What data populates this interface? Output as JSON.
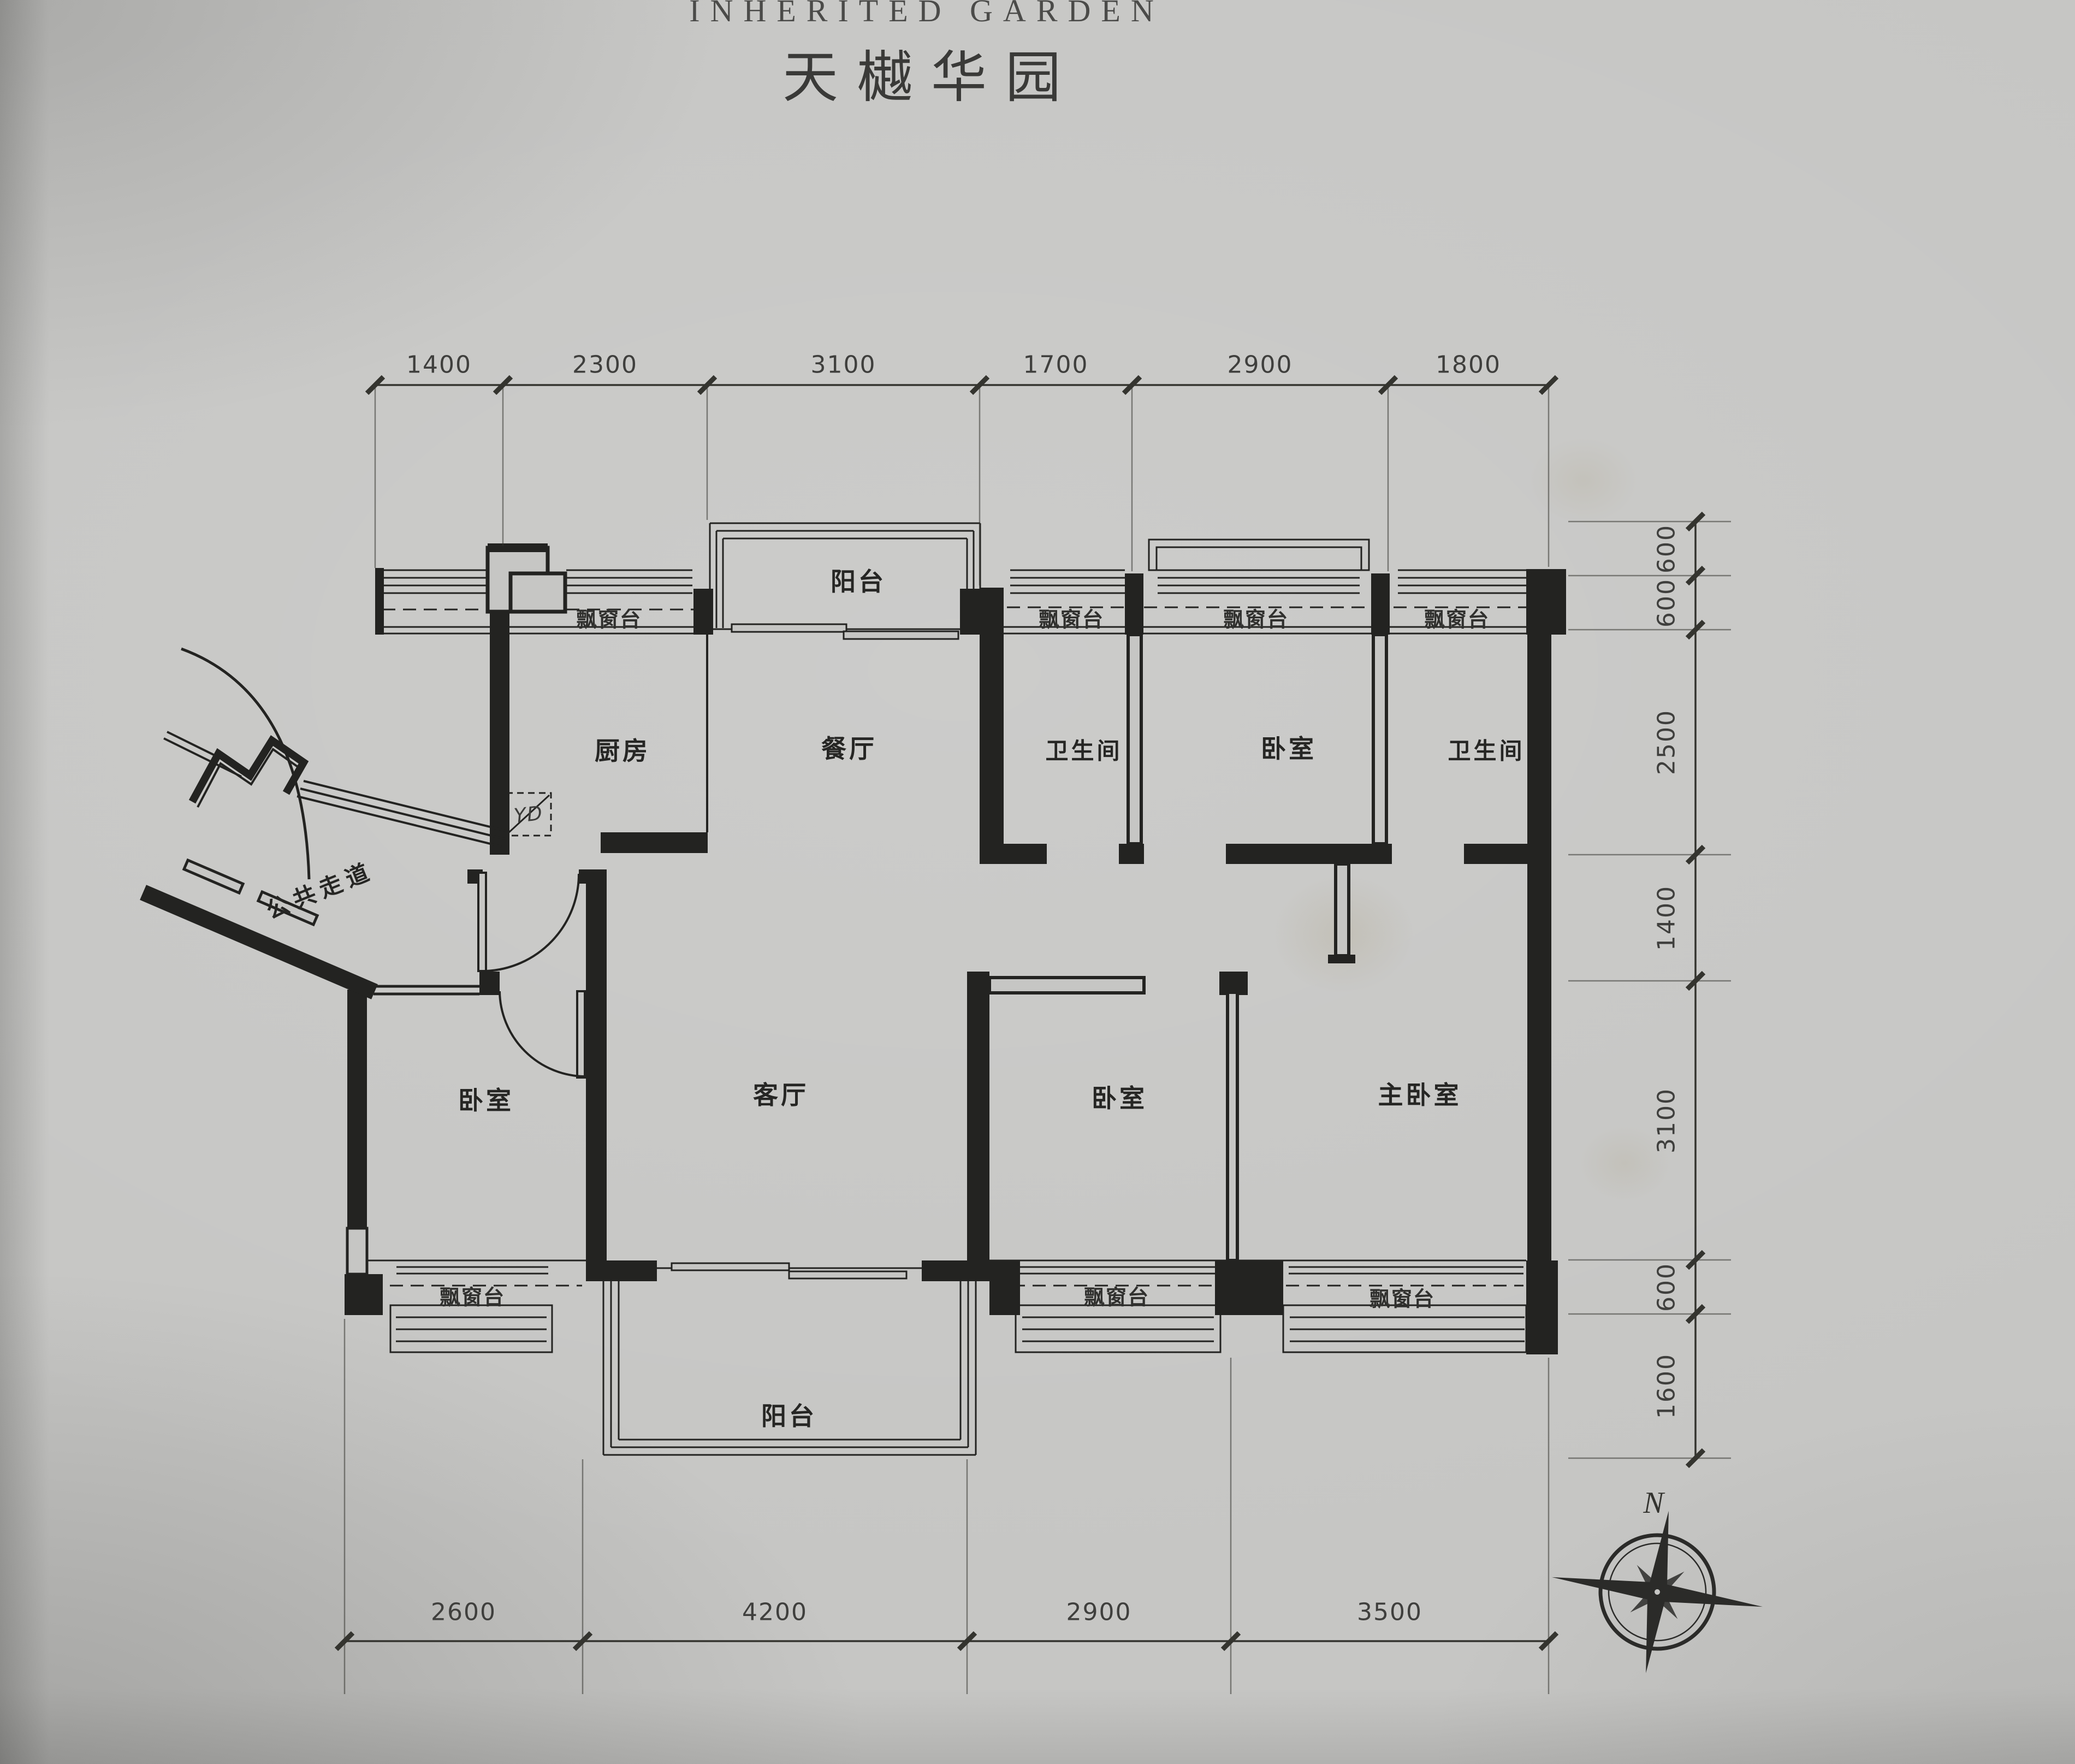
{
  "header": {
    "title_en": "INHERITED GARDEN",
    "title_zh": "天樾华园"
  },
  "plan": {
    "rooms": [
      {
        "id": "kitchen",
        "label": "厨房"
      },
      {
        "id": "dining",
        "label": "餐厅"
      },
      {
        "id": "bath_top_left",
        "label": "卫生间"
      },
      {
        "id": "bed_top",
        "label": "卧室"
      },
      {
        "id": "bath_top_right",
        "label": "卫生间"
      },
      {
        "id": "corridor",
        "label": "公共走道"
      },
      {
        "id": "bed_left",
        "label": "卧室"
      },
      {
        "id": "living",
        "label": "客厅"
      },
      {
        "id": "bed_mid",
        "label": "卧室"
      },
      {
        "id": "master",
        "label": "主卧室"
      },
      {
        "id": "balcony_top",
        "label": "阳台"
      },
      {
        "id": "balcony_bottom",
        "label": "阳台"
      }
    ],
    "bay_windows": [
      {
        "id": "bay_kitchen",
        "label": "飘窗台"
      },
      {
        "id": "bay_bath_left",
        "label": "飘窗台"
      },
      {
        "id": "bay_bed_top",
        "label": "飘窗台"
      },
      {
        "id": "bay_bath_right",
        "label": "飘窗台"
      },
      {
        "id": "bay_bed_left",
        "label": "飘窗台"
      },
      {
        "id": "bay_bed_mid",
        "label": "飘窗台"
      },
      {
        "id": "bay_master",
        "label": "飘窗台"
      }
    ],
    "meter_box": {
      "label": "YD"
    },
    "compass": {
      "north": "N"
    }
  },
  "dimensions": {
    "unit": "mm",
    "top": {
      "values": [
        "1400",
        "2300",
        "3100",
        "1700",
        "2900",
        "1800"
      ]
    },
    "right": {
      "values": [
        "600",
        "600",
        "2500",
        "1400",
        "3100",
        "600",
        "1600"
      ]
    },
    "bottom": {
      "values": [
        "2600",
        "4200",
        "2900",
        "3500"
      ]
    }
  },
  "colors": {
    "paper": "#c6c6c4",
    "ink": "#232321",
    "label_text": "#2c2c2a",
    "dim_text": "#3f3f3d"
  }
}
